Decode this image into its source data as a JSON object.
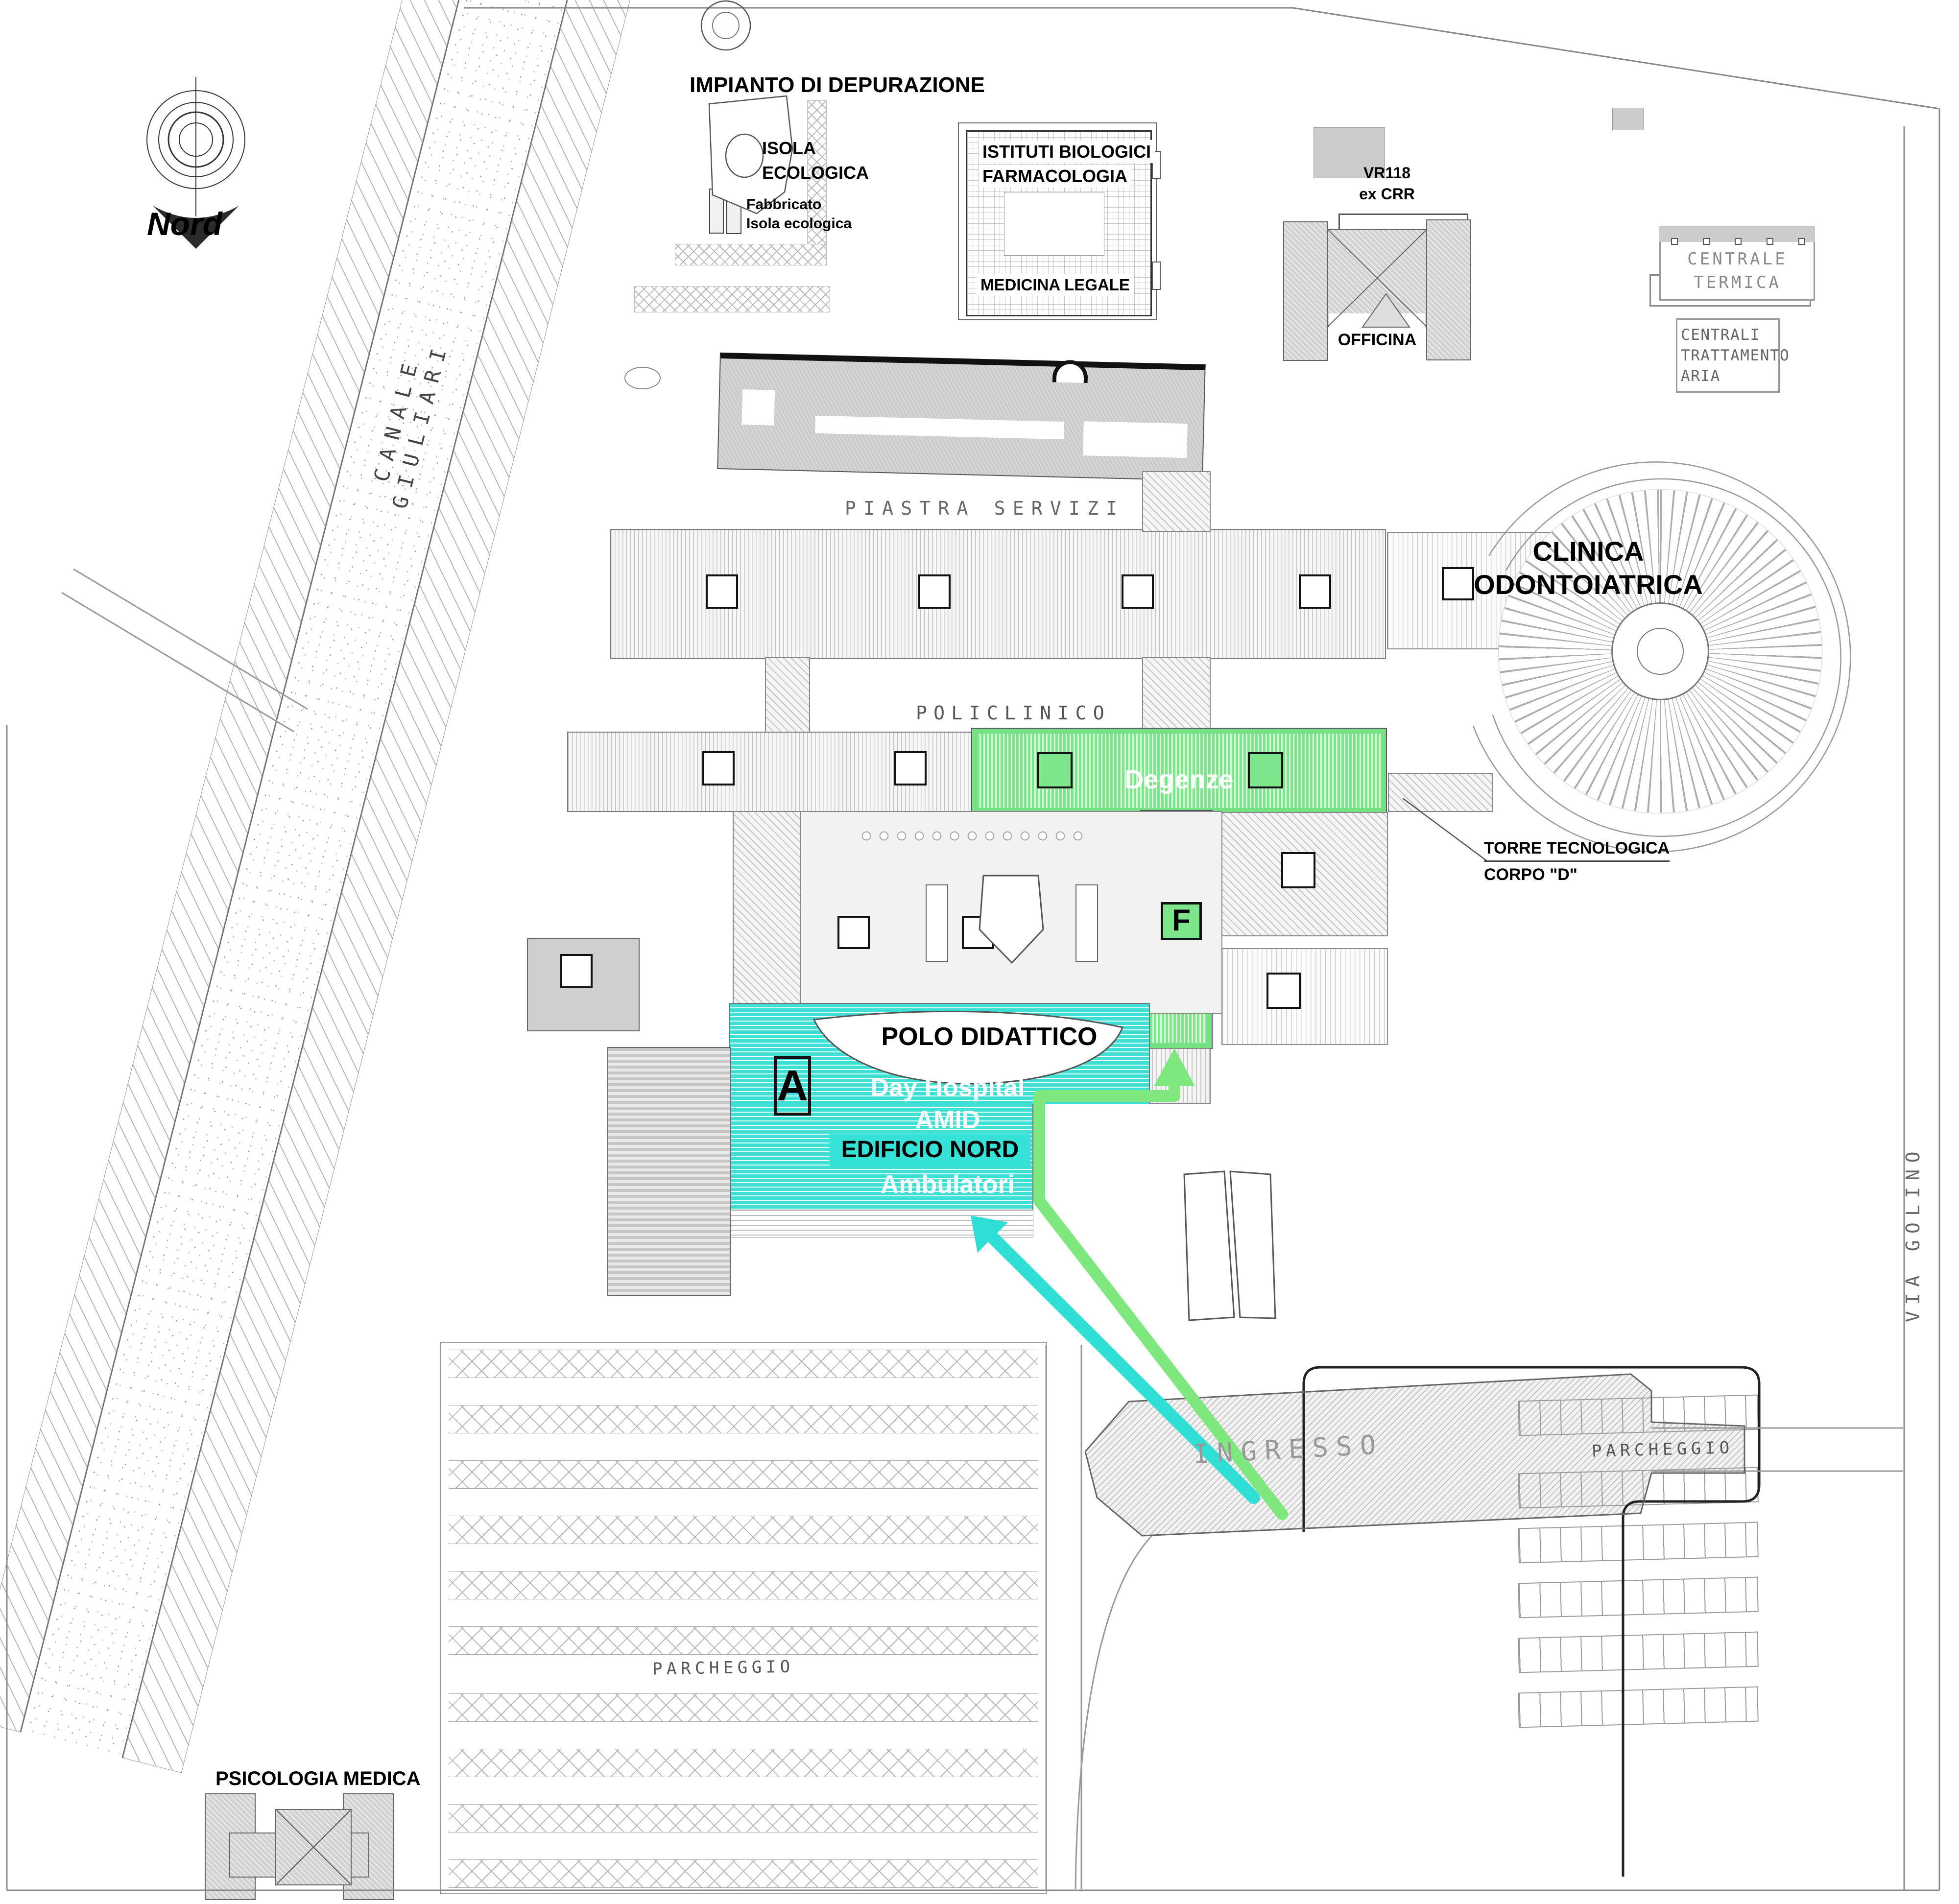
{
  "title": "Hospital campus site plan (wayfinding map)",
  "compass": {
    "label": "Nord"
  },
  "streets": {
    "canal": "CANALE GIULIARI",
    "via_golino": "VIA GOLINO"
  },
  "labels": {
    "impianto": "IMPIANTO DI DEPURAZIONE",
    "isola": "ISOLA\nECOLOGICA",
    "fabbricato": "Fabbricato\nIsola ecologica",
    "istituti": "ISTITUTI BIOLOGICI",
    "farmacologia": "FARMACOLOGIA",
    "medicina": "MEDICINA LEGALE",
    "vr118": "VR118\nex CRR",
    "officina": "OFFICINA",
    "centrale_termica": "CENTRALE\nTERMICA",
    "centrali_aria": "CENTRALI\nTRATTAMENTO\nARIA",
    "piastra_servizi": "PIASTRA SERVIZI",
    "clinica": "CLINICA\nODONTOIATRICA",
    "policlinico": "POLICLINICO",
    "degenze": "Degenze",
    "torre": "TORRE TECNOLOGICA",
    "corpo_d": "CORPO \"D\"",
    "badge_f": "F",
    "badge_a": "A",
    "polo_didattico": "POLO DIDATTICO",
    "day_hospital": "Day Hospital",
    "amid": "AMID",
    "edificio_nord": "EDIFICIO NORD",
    "ambulatori": "Ambulatori",
    "ingresso": "INGRESSO",
    "parcheggio_est": "PARCHEGGIO",
    "parcheggio_ovest": "PARCHEGGIO",
    "psicologia": "PSICOLOGIA MEDICA"
  },
  "colors": {
    "highlight_green": "#7de68b",
    "highlight_green_border": "#74e183",
    "highlight_cyan": "#3fdfd6",
    "edificio_nord_band": "#35e2d8",
    "route_green_arrow": "#7ee87e",
    "route_cyan_arrow": "#2fdfd6"
  }
}
